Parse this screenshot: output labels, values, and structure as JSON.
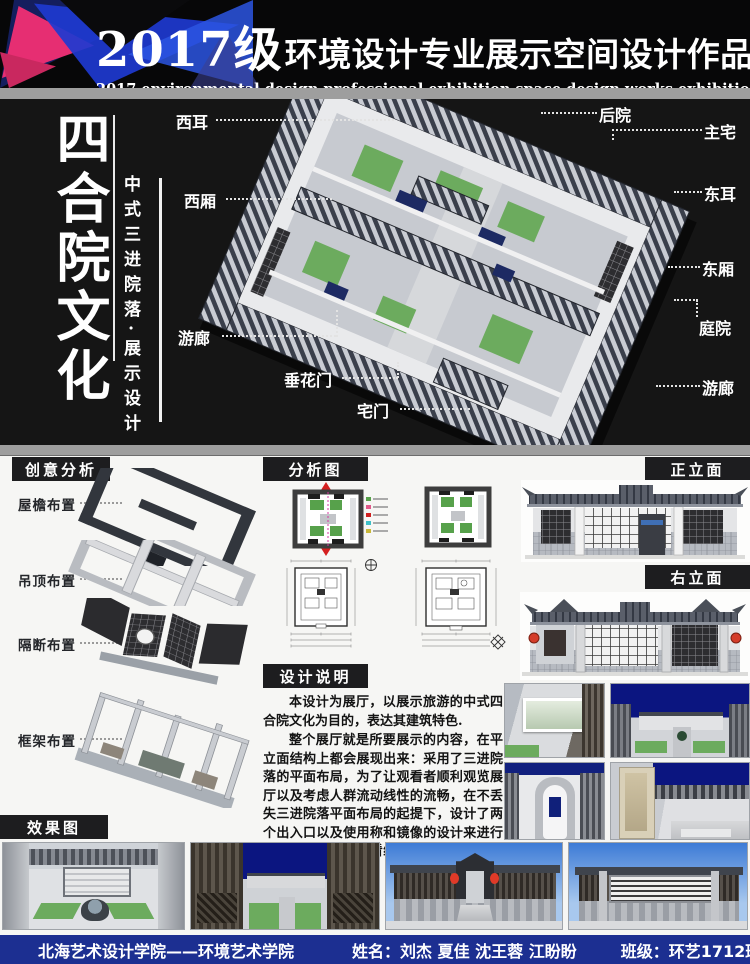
{
  "header": {
    "title_year": "2017级",
    "title_rest": "环境设计专业展示空间设计作品展",
    "subtitle": "2017 environmental design professional exhibition space design works exhibition"
  },
  "hero": {
    "main_title": "四合院文化",
    "sub_title": "中式三进院落·展示设计",
    "labels": {
      "xi_er": "西耳",
      "xi_xiang": "西厢",
      "you_lang_left": "游廊",
      "chui_hua_men": "垂花门",
      "zhai_men": "宅门",
      "hou_yuan": "后院",
      "zhu_zhai": "主宅",
      "dong_er": "东耳",
      "dong_xiang": "东厢",
      "ting_yuan": "庭院",
      "you_lang_right": "游廊"
    }
  },
  "sections": {
    "creative": "创意分析",
    "analysis": "分析图",
    "front_elev": "正立面",
    "right_elev": "右立面",
    "notes": "设计说明",
    "effects": "效果图"
  },
  "creative_items": [
    "屋檐布置",
    "吊顶布置",
    "隔断布置",
    "框架布置"
  ],
  "design_notes": {
    "p1": "本设计为展厅，以展示旅游的中式四合院文化为目的，表达其建筑特色.",
    "p2": "整个展厅就是所要展示的内容，在平立面结构上都会展现出来：采用了三进院落的平面布局，为了让观看者顺利观览展厅以及考虑人群流动线性的流畅，在不丢失三进院落平面布局的起提下，设计了两个出入口以及使用称和镜像的设计来进行平面分布，使得观看线路不重叠，人群不会因此堵塞。"
  },
  "footer": {
    "school": "北海艺术设计学院——环境艺术学院",
    "names_label": "姓名：",
    "names": "刘杰 夏佳 沈王蓉 江盼盼",
    "class_label": "班级：",
    "class_value": "环艺1712班"
  },
  "colors": {
    "footer_bar": "#1c2f91",
    "accent_pink": "#e62e72",
    "accent_blue": "#1e3ad0",
    "night_sky": "#0b1580",
    "day_sky": "#3d7bd6",
    "lawn_green": "#6cab5e",
    "lantern_red": "#d43c2a",
    "roof_dark": "#3a3f4b",
    "plan_legend": [
      "#57a14b",
      "#e05a8a",
      "#cf1f1f",
      "#3fc0c8",
      "#c9b83a"
    ]
  }
}
